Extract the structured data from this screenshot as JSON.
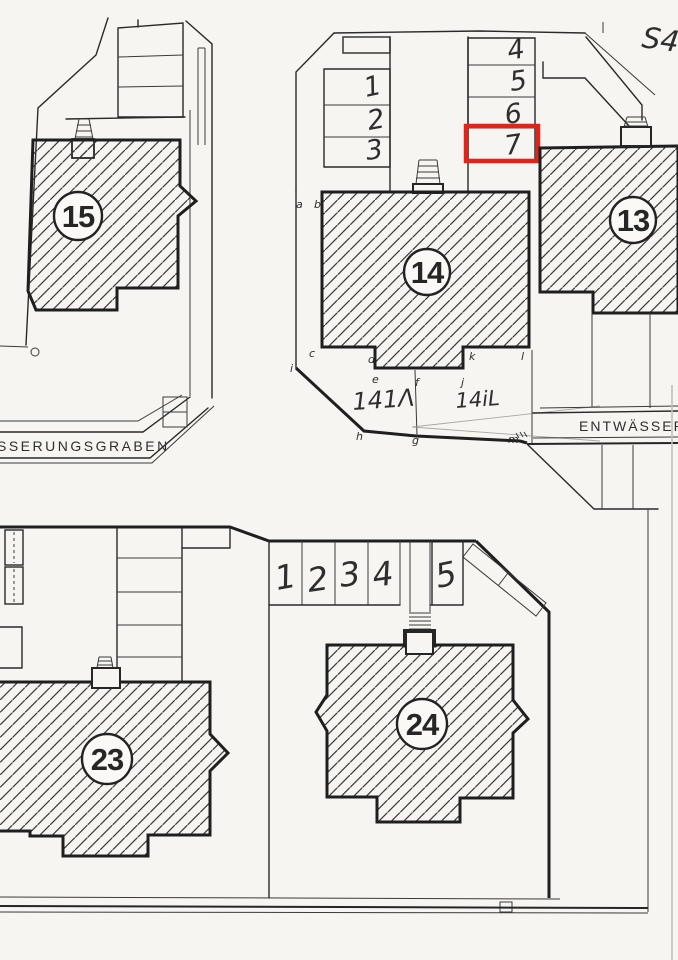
{
  "page": {
    "background": "#f6f5f1",
    "ink": "#262626",
    "red": "#e2231a",
    "pencil": "#8e8e8e"
  },
  "margin_note": "S4",
  "buildings": {
    "b13": "13",
    "b14": "14",
    "b15": "15",
    "b23": "23",
    "b24": "24"
  },
  "upper_stalls": {
    "left": [
      "1",
      "2",
      "3"
    ],
    "right": [
      "4",
      "5",
      "6",
      "7"
    ],
    "highlighted": "7"
  },
  "lower_stalls": [
    "1",
    "2",
    "3",
    "4",
    "5"
  ],
  "roads": {
    "left_label": "SSERUNGSGRABEN",
    "right_label": "ENTWÄSSERU"
  },
  "parcels": {
    "left": "141Λ",
    "right": "14iL"
  },
  "boundary_letters": {
    "a": "a",
    "b": "b",
    "c": "c",
    "d": "d",
    "e": "e",
    "f": "f",
    "g": "g",
    "h": "h",
    "i": "i",
    "j": "j",
    "k": "k",
    "l": "l",
    "m": "m"
  }
}
